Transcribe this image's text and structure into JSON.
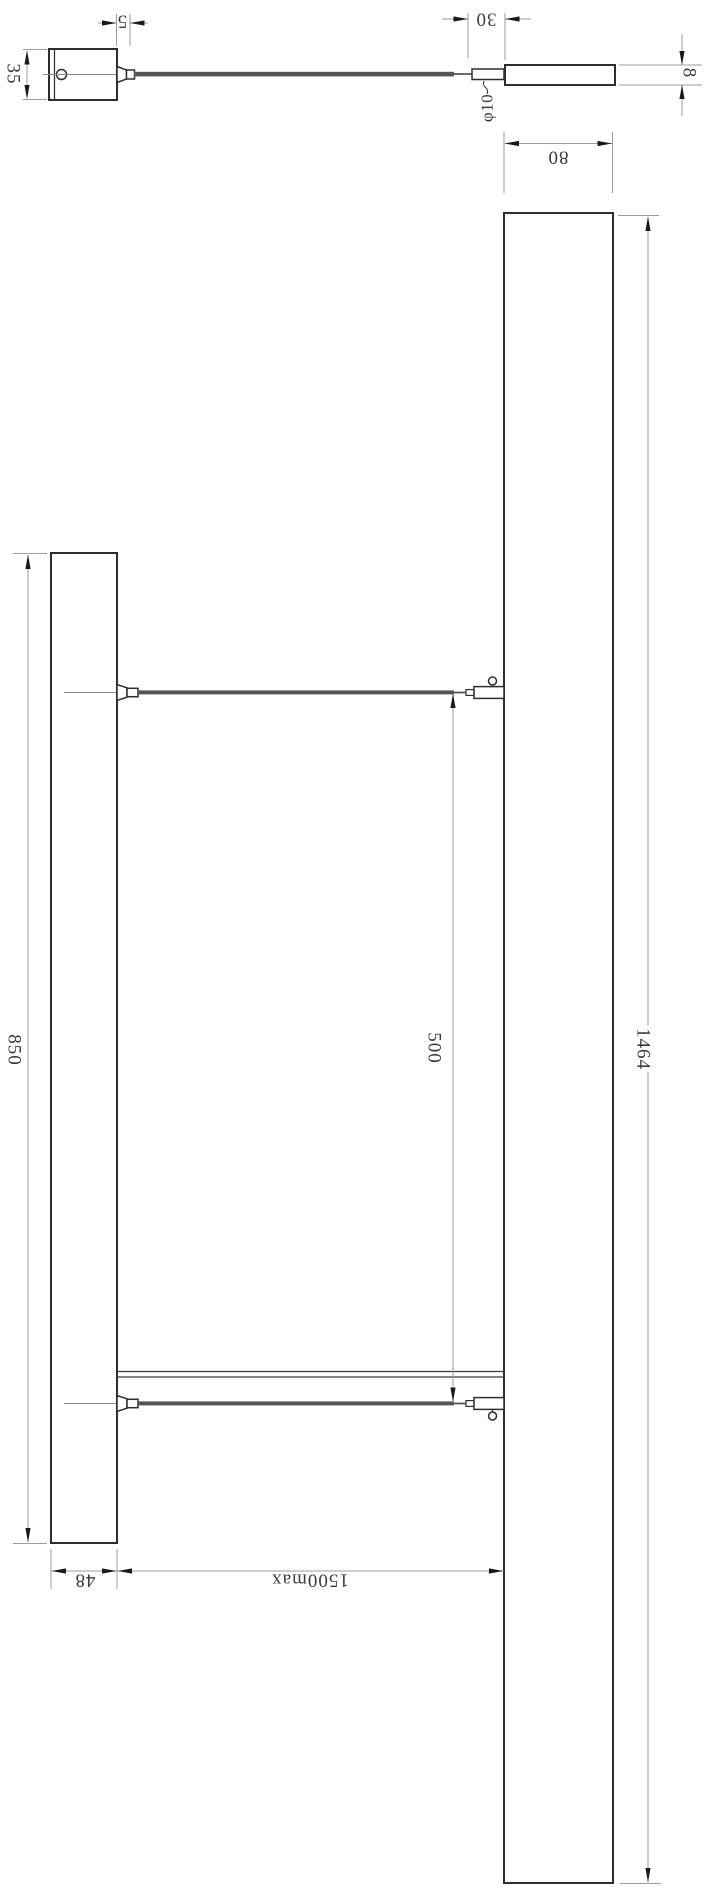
{
  "colors": {
    "object_line": "#2e2e2e",
    "dimension_line": "#9c9c9c",
    "label_text": "#3a3a3a",
    "wire_fill": "#555555",
    "background": "#ffffff"
  },
  "dimensions": {
    "canopy_plate_height": "35",
    "canopy_grip_offset": "5",
    "end_cap_length": "30",
    "cable_diameter": "φ10",
    "profile_thickness": "8",
    "profile_width": "80",
    "canopy_length": "850",
    "canopy_width": "48",
    "fixture_length": "1464",
    "wire_spacing": "500",
    "suspension_max": "1500max"
  }
}
